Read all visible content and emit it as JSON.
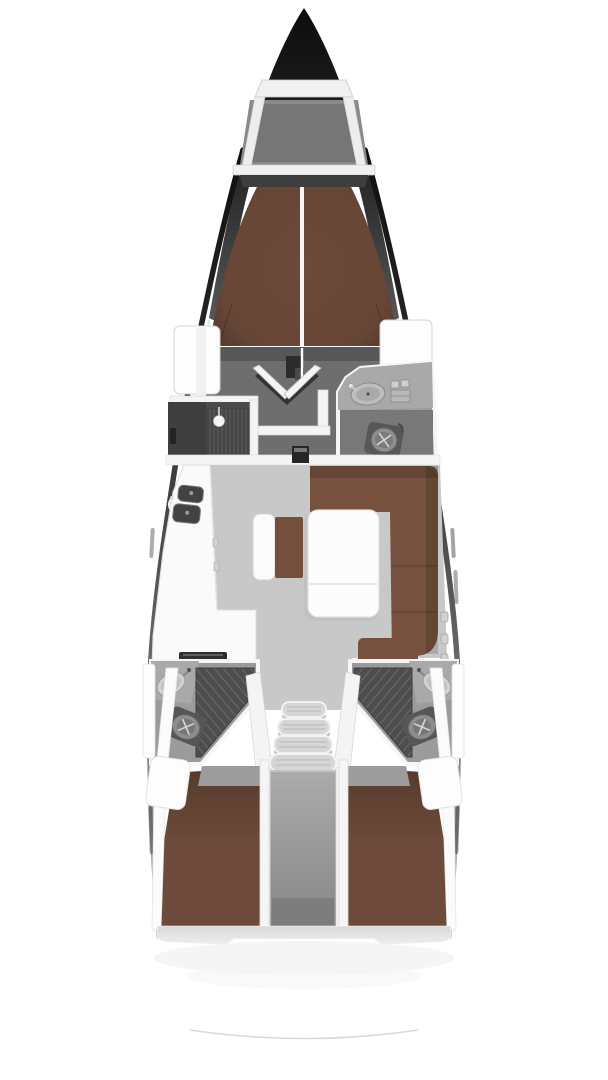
{
  "plan": {
    "type": "boat-floor-plan",
    "view": "top-down interior layout of a sailing yacht hull, no text labels"
  },
  "colors": {
    "background": "#ffffff",
    "hull_dark": "#161616",
    "anchor_locker_gray": "#8a8a8a",
    "anchor_locker_inner": "#767676",
    "forepeak_dark": "#3e3e3e",
    "berth_brown": "#6d4a39",
    "sofa_brown": "#76523e",
    "bench_cushion_brown": "#74503c",
    "saloon_floor_gray": "#c8c8c8",
    "cabin_floor_gray": "#6e6e6e",
    "head_floor_gray": "#9b9b9b",
    "head_counter_gray": "#a9a9a9",
    "shower_gray": "#4e4e4e",
    "wardrobe_gray": "#4a4a4a",
    "wardrobe_panel": "#454545",
    "engine_gray": "#9e9e9e",
    "furniture_white": "#fafafa",
    "wall_white": "#f4f4f4",
    "stove_black": "#2e2e2e",
    "sink_dark_gray": "#424242",
    "table_white": "#fcfcfc",
    "footboard_gray": "#575757",
    "threshold_black": "#262626",
    "landing_gray": "#c2c2c2",
    "foot_strip_gray": "#dcdcdc"
  },
  "areas": [
    {
      "id": "anchor-locker",
      "label": "Bow anchor locker"
    },
    {
      "id": "v-berth",
      "label": "Forward cabin V-berth"
    },
    {
      "id": "forward-cabin-floor",
      "label": "Forward cabin floor"
    },
    {
      "id": "wardrobe",
      "label": "Port hanging wardrobe"
    },
    {
      "id": "forward-head",
      "label": "Forward head with sink and toilet"
    },
    {
      "id": "saloon",
      "label": "Saloon"
    },
    {
      "id": "galley",
      "label": "Port L-shaped galley with twin sinks and stove"
    },
    {
      "id": "center-bench",
      "label": "Centerline bench seat"
    },
    {
      "id": "saloon-table",
      "label": "Folding saloon table"
    },
    {
      "id": "l-sofa",
      "label": "Starboard L-shaped sofa with chaise"
    },
    {
      "id": "companionway-stairs",
      "label": "Companionway stairs, four treads"
    },
    {
      "id": "port-aft-head",
      "label": "Port aft head with shower, sink, toilet"
    },
    {
      "id": "starboard-aft-head",
      "label": "Starboard aft head with shower, sink, toilet"
    },
    {
      "id": "engine-compartment",
      "label": "Center engine compartment"
    },
    {
      "id": "port-aft-cabin",
      "label": "Port aft double cabin"
    },
    {
      "id": "starboard-aft-cabin",
      "label": "Starboard aft double cabin"
    },
    {
      "id": "stern",
      "label": "Stern / transom"
    }
  ]
}
